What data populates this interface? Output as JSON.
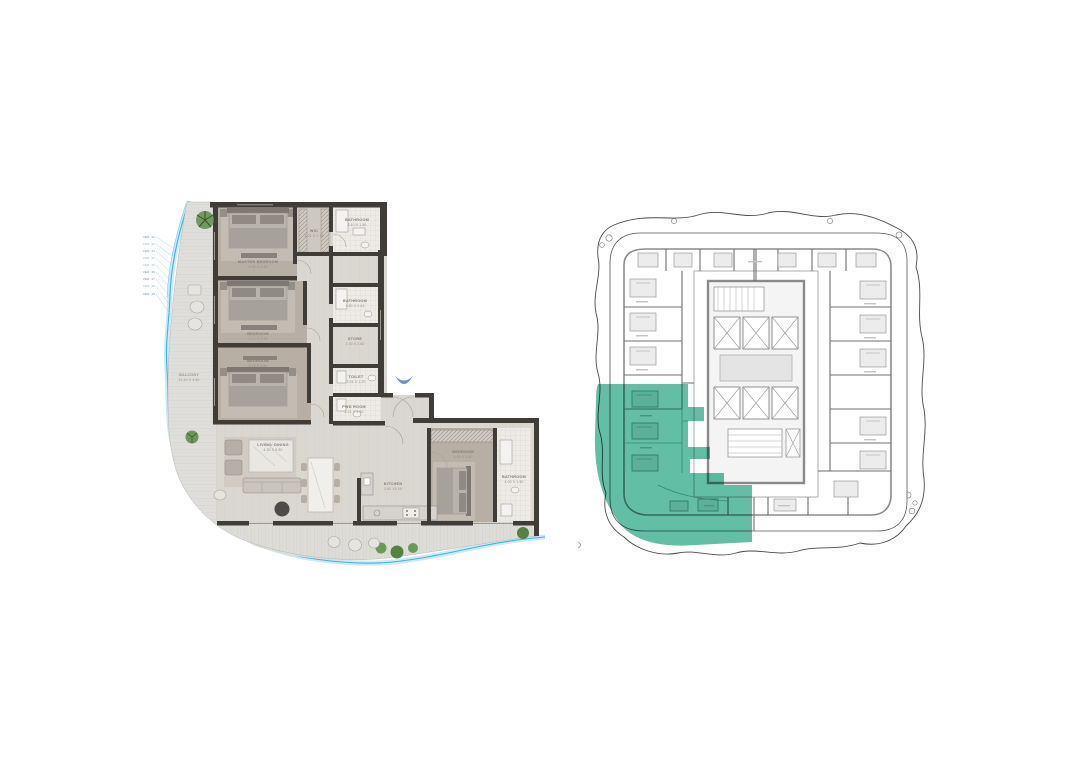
{
  "page": {
    "title": "Apartment floor plan with key plan",
    "background": "#ffffff"
  },
  "left_plan": {
    "rooms": [
      {
        "name": "MASTER BEDROOM",
        "dims": "3.95 X 4.10"
      },
      {
        "name": "WIC",
        "dims": "2.01 X 1.75"
      },
      {
        "name": "BATHROOM",
        "dims": "3.10 X 1.80"
      },
      {
        "name": "BEDROOM",
        "dims": "3.70 X 3.75"
      },
      {
        "name": "BATHROOM",
        "dims": "1.80 X 2.62"
      },
      {
        "name": "STORE",
        "dims": "2.00 X 2.60"
      },
      {
        "name": "TOILET",
        "dims": "2.04 X 1.20"
      },
      {
        "name": "BEDROOM",
        "dims": "2.75 X 3.80"
      },
      {
        "name": "PWD ROOM",
        "dims": "2.21 X 1.60"
      },
      {
        "name": "LIVING/ DINING",
        "dims": "4.30 X 6.80"
      },
      {
        "name": "KITCHEN",
        "dims": "3.60 X3.00"
      },
      {
        "name": "BEDROOM",
        "dims": "4.00 X 3.80"
      },
      {
        "name": "BATHROOM",
        "dims": "4.00 X 1.50"
      },
      {
        "name": "BALCONY",
        "dims": "21.10 X 3.60"
      }
    ],
    "annotations": [
      "VER. 41",
      "VER. 42",
      "VER. 43",
      "VER. 44",
      "VER. 45",
      "VER. 46",
      "VER. 47",
      "VER. 48",
      "VER. 49"
    ],
    "colors": {
      "wall": "#403c38",
      "bedroom_floor": "#b7aea4",
      "water": "#3fb0de",
      "greenery": "#55823f",
      "entry_marker": "#6b90c9"
    }
  },
  "right_plan": {
    "colors": {
      "highlight": "#5ebda2",
      "lines": "#6b6b6b",
      "core": "#b5b5b5"
    }
  }
}
